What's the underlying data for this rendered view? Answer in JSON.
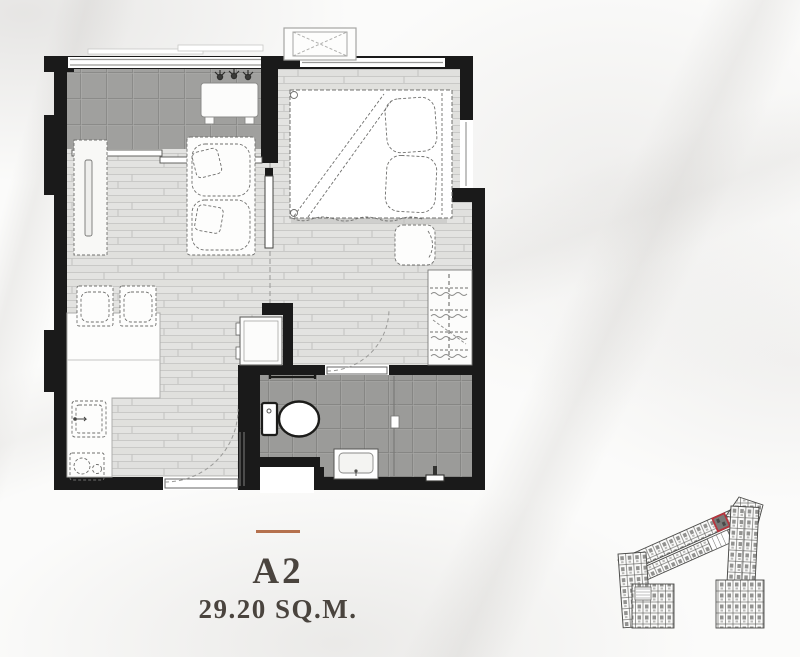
{
  "unit": {
    "code": "A2",
    "area_label": "29.20 SQ.M."
  },
  "colors": {
    "wall": "#1a1a1a",
    "accent": "#b5714e",
    "text": "#4a443e",
    "floor": "#e3e3e1",
    "balcony_tile": "#a0a09e",
    "bath_tile": "#9b9b99",
    "keyplan_highlight": "#b3242e",
    "background": "#fbfbfa"
  },
  "floorplan": {
    "rooms": [
      "balcony",
      "living-area",
      "bedroom",
      "kitchen-dining",
      "bathroom",
      "entrance"
    ],
    "furniture_icons": [
      "planter-icons",
      "outdoor-bench",
      "sliding-door",
      "tv-console",
      "tv",
      "sofa",
      "dining-chairs",
      "kitchen-counter",
      "sink",
      "stove",
      "fridge",
      "entrance-door",
      "bed",
      "pillows",
      "bedside-stool",
      "wardrobe",
      "ac-condenser-unit",
      "bathroom-door",
      "toilet",
      "towel-bar",
      "vanity-sink",
      "shower-glass-partition",
      "shower-fixture"
    ]
  },
  "keyplan": {
    "highlighted_unit": "A2"
  }
}
